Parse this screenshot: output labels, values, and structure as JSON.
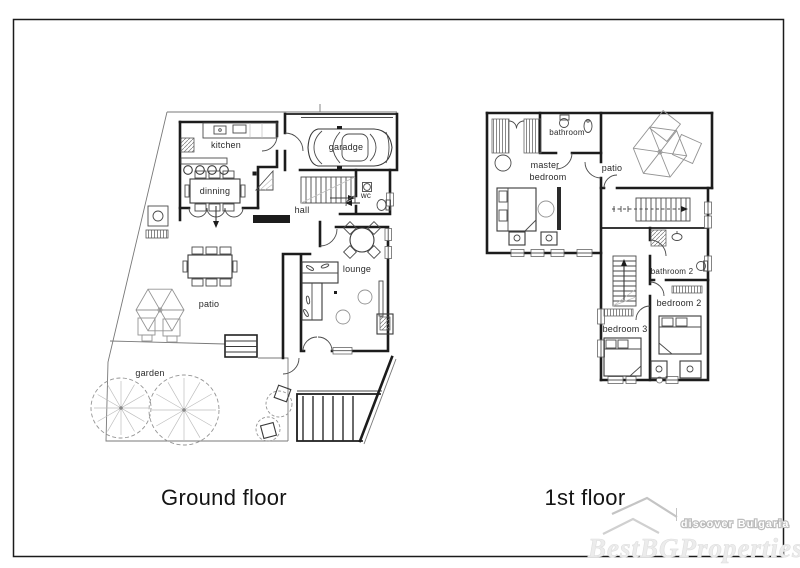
{
  "ground_floor": {
    "title": "Ground floor",
    "rooms": {
      "kitchen": "kitchen",
      "dinning": "dinning",
      "hall": "hall",
      "wc": "wc",
      "garage": "garadge",
      "lounge": "lounge",
      "patio": "patio",
      "garden": "garden"
    }
  },
  "first_floor": {
    "title": "1st floor",
    "rooms": {
      "master_line1": "master",
      "master_line2": "bedroom",
      "bathroom": "bathroom",
      "patio": "patio",
      "bathroom2": "bathroom 2",
      "bedroom2": "bedroom 2",
      "bedroom3": "bedroom 3"
    }
  },
  "watermark": {
    "tagline": "discover Bulgaria",
    "brand": "BestBGProperties"
  },
  "colors": {
    "wall": "#1c1c1c",
    "accent-gray": "#c4c4c4",
    "watermark-text": "#ececec"
  }
}
